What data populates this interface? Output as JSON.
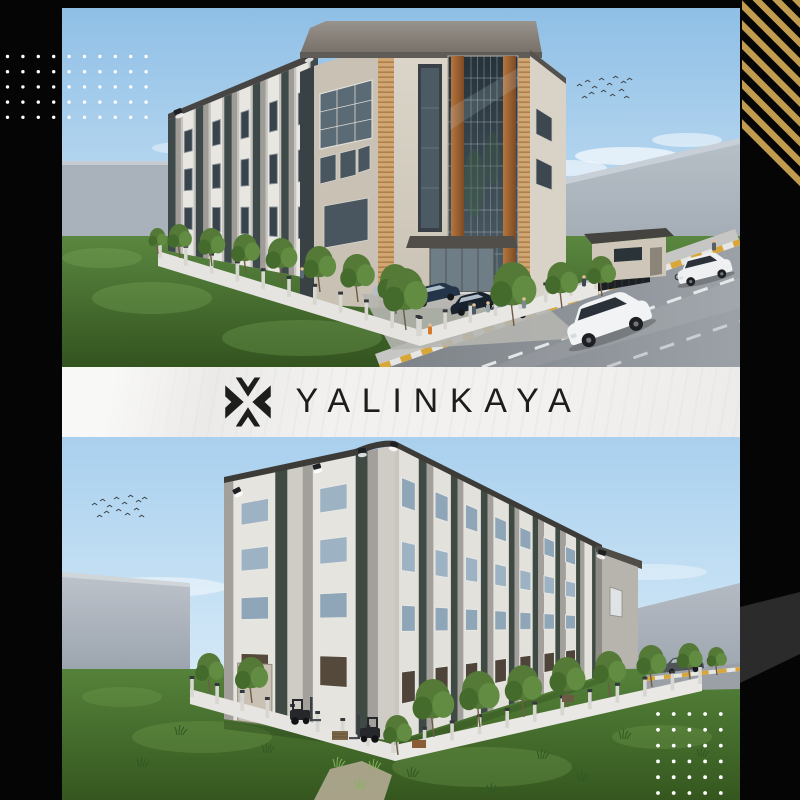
{
  "brand": {
    "name": "YALINKAYA"
  },
  "logo": {
    "icon": "x-chevron-mark"
  },
  "colors": {
    "frame": "#050505",
    "band_background": "#f2f1ef",
    "brand_ink": "#1d1d1b",
    "gold_accent": "#c19c4e",
    "wedge_gray": "#2b2b2b",
    "dots_white": "#ffffff"
  },
  "decorations": {
    "dot_grids": [
      {
        "name": "top-left-dot-grid",
        "x": 7.5,
        "y": 56.5,
        "cols": 10,
        "rows": 5,
        "dx": 15.4,
        "dy": 15.2,
        "r": 1.7
      },
      {
        "name": "bottom-right-dot-grid",
        "x": 658,
        "y": 714,
        "cols": 5,
        "rows": 6,
        "dx": 15.7,
        "dy": 15.8,
        "r": 1.9
      }
    ],
    "gold_ribbon": {
      "points": "742,0 800,0 800,187 742,131",
      "angle": -45
    },
    "gray_wedge": {
      "points": "740,607 800,592 800,654 740,683"
    }
  },
  "scenes": {
    "top": {
      "name": "building-render-front-view",
      "palette": {
        "sky_top": "#8fbfe6",
        "sky_bottom": "#d8ebf7",
        "grass_top": "#5a8740",
        "grass_bottom": "#33531f",
        "facade_dark": "#3e4a49",
        "facade_light": "#c6c3be",
        "tower_beige": "#d8d2c6",
        "wood_accent": "#ad6c38",
        "cap_gray": "#8b8680",
        "road": "#8a9095",
        "curb_yellow": "#d8a73a"
      }
    },
    "bottom": {
      "name": "building-render-rear-view",
      "palette": {
        "sky_top": "#a9d0ee",
        "sky_bottom": "#e6f3fb",
        "grass_top": "#55823a",
        "grass_bottom": "#35571f",
        "facade_dark": "#3e4a43",
        "facade_light": "#d4d1cb",
        "fence_white": "#e7e5e1",
        "roof_dark": "#3c3b38"
      }
    }
  }
}
